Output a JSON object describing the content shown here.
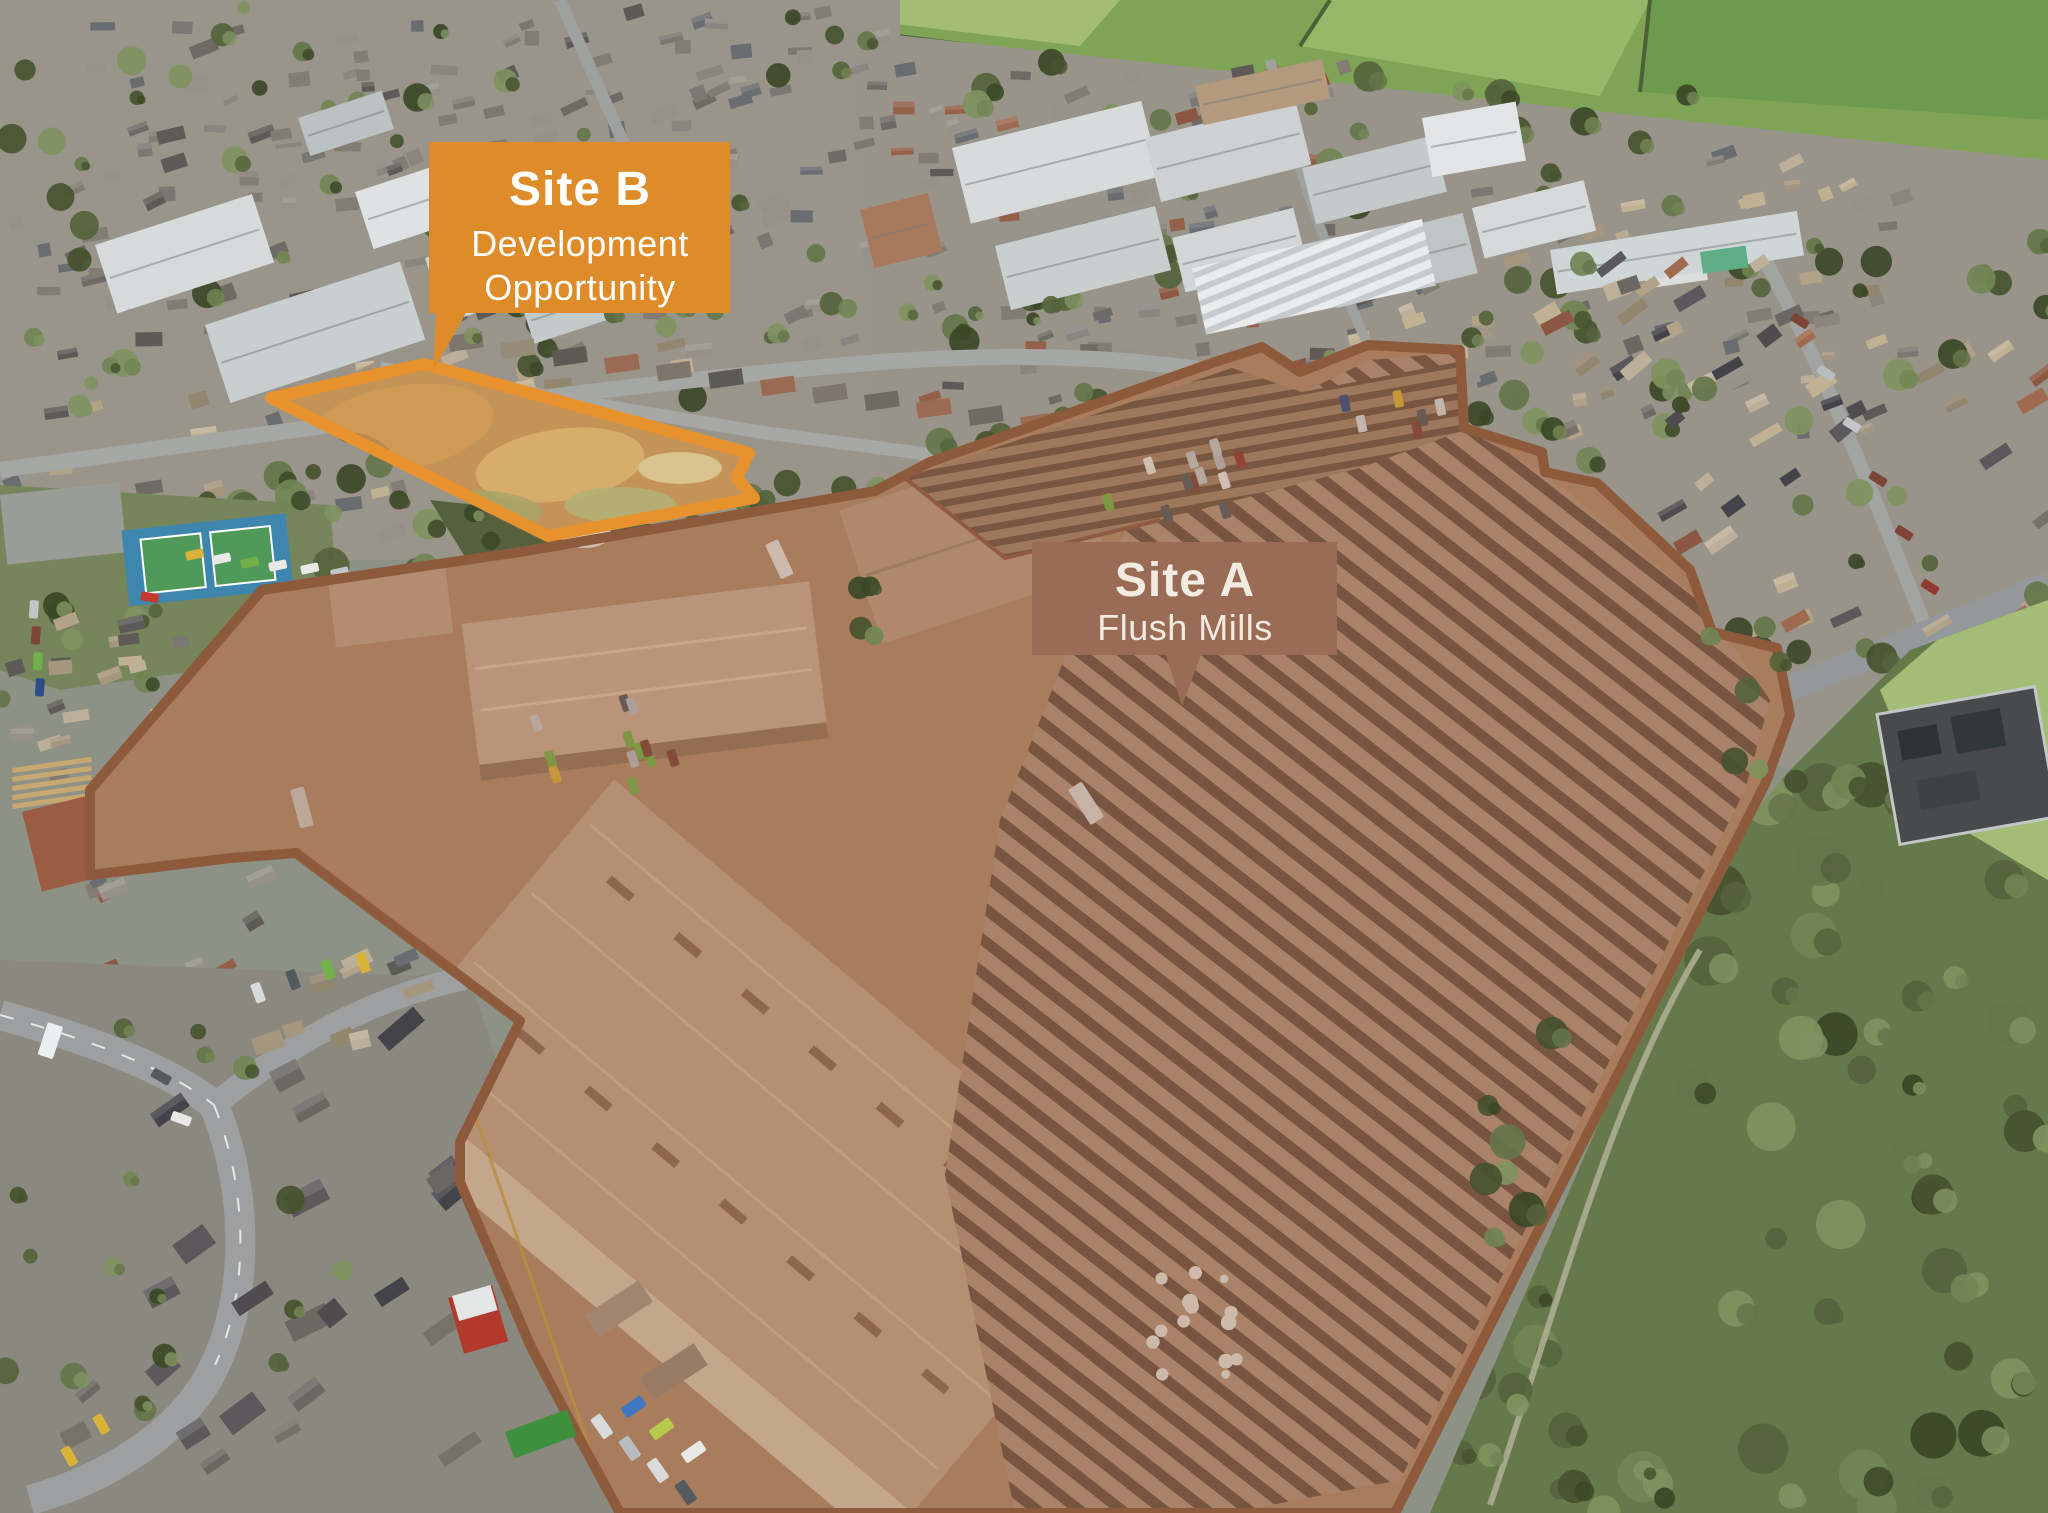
{
  "page": {
    "title": "Aerial site plan photograph",
    "width": 2048,
    "height": 1513
  },
  "labels": {
    "site_b": {
      "title": "Site B",
      "line1": "Development",
      "line2": "Opportunity",
      "bg_color": "#DE8C2A",
      "text_color": "#FFFFFF"
    },
    "site_a": {
      "title": "Site A",
      "subtitle": "Flush Mills",
      "bg_color": "#9A6C55",
      "text_color": "#F2EBE2"
    }
  },
  "overlays": {
    "site_a": {
      "name": "Site A boundary highlight",
      "outline_color": "#8D5A3C",
      "fill_tint": "rgba(150,94,60,0.30)"
    },
    "site_b": {
      "name": "Site B plot outline",
      "outline_color": "#E8922E"
    }
  }
}
